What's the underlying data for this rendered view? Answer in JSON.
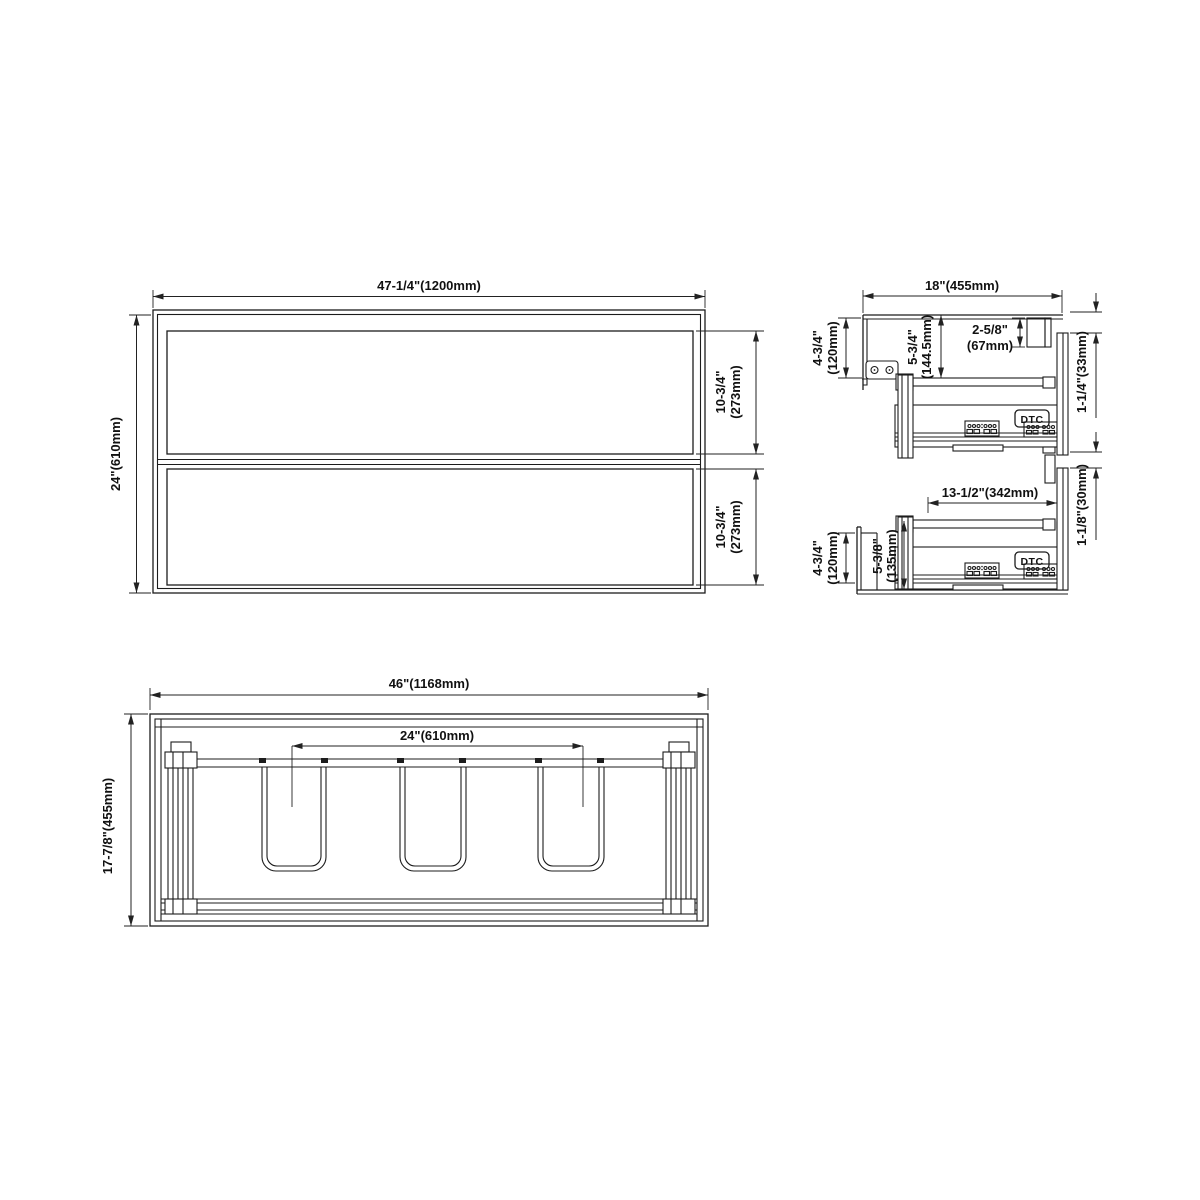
{
  "front": {
    "dim_width": "47-1/4\"(1200mm)",
    "dim_height": "24\"(610mm)",
    "dim_drawer1_in": "10-3/4\"",
    "dim_drawer1_mm": "(273mm)",
    "dim_drawer2_in": "10-3/4\"",
    "dim_drawer2_mm": "(273mm)"
  },
  "side": {
    "dim_depth": "18\"(455mm)",
    "dim_top_back_in": "4-3/4\"",
    "dim_top_back_mm": "(120mm)",
    "dim_top_rail_in": "5-3/4\"",
    "dim_top_rail_mm": "(144.5mm)",
    "dim_hang_rail_in": "2-5/8\"",
    "dim_hang_rail_mm": "(67mm)",
    "dim_front_top_gap": "1-1/4\"(33mm)",
    "dim_slide_length": "13-1/2\"(342mm)",
    "dim_front_mid_gap": "1-1/8\"(30mm)",
    "dim_bottom_back_in": "4-3/4\"",
    "dim_bottom_back_mm": "(120mm)",
    "dim_drawer_box_in": "5-3/8\"",
    "dim_drawer_box_mm": "(135mm)",
    "slide_brand": "DTC"
  },
  "plan": {
    "dim_width": "46\"(1168mm)",
    "dim_sink_centers": "24\"(610mm)",
    "dim_depth": "17-7/8\"(455mm)"
  }
}
